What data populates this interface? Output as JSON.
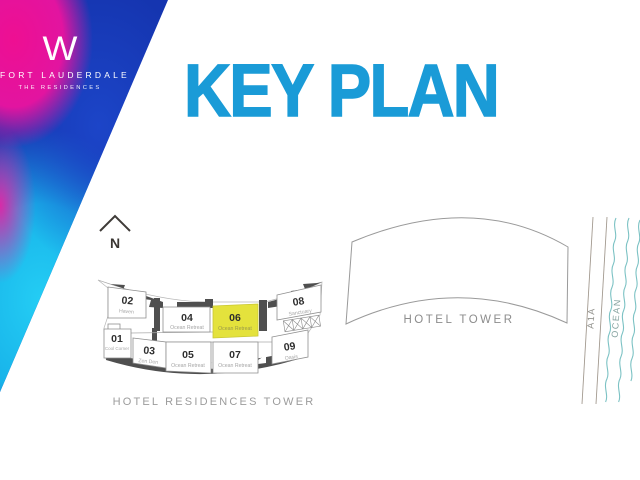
{
  "brand": {
    "logo_letter": "W",
    "name": "FORT LAUDERDALE",
    "residences": "THE RESIDENCES"
  },
  "title": "KEY PLAN",
  "key_plan": {
    "north_label": "N",
    "building_label": "HOTEL RESIDENCES TOWER",
    "units": [
      {
        "num": "01",
        "name": "Cool Corner",
        "highlighted": false
      },
      {
        "num": "02",
        "name": "Haven",
        "highlighted": false
      },
      {
        "num": "03",
        "name": "Zen Den",
        "highlighted": false
      },
      {
        "num": "04",
        "name": "Ocean Retreat",
        "highlighted": false
      },
      {
        "num": "05",
        "name": "Ocean Retreat",
        "highlighted": false
      },
      {
        "num": "06",
        "name": "Ocean Retreat",
        "highlighted": true
      },
      {
        "num": "07",
        "name": "Ocean Retreat",
        "highlighted": false
      },
      {
        "num": "08",
        "name": "Sanctuary",
        "highlighted": false
      },
      {
        "num": "09",
        "name": "Oasis",
        "highlighted": false
      }
    ]
  },
  "map": {
    "hotel_tower_label": "HOTEL TOWER",
    "road_label": "A1A",
    "ocean_label": "OCEAN"
  },
  "colors": {
    "title_blue": "#1a9bd7",
    "highlight_yellow": "#e4e23c",
    "building_mass_gray": "#4f4f4f",
    "ocean_teal": "#7cc2c4",
    "logo_magenta": "#ee0f92",
    "logo_blue": "#1535b0",
    "logo_cyan": "#24cdf4"
  }
}
